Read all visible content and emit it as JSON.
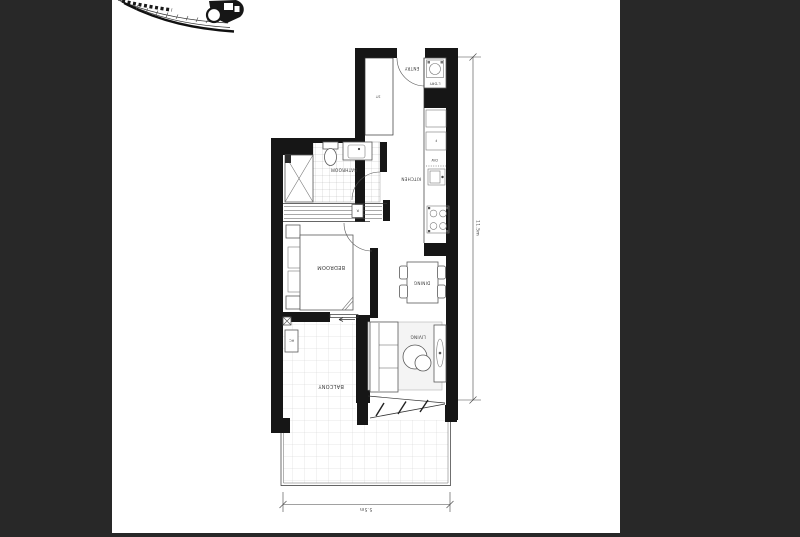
{
  "colors": {
    "canvas_bg": "#282828",
    "page_bg": "#ffffff",
    "wall": "#161616",
    "tile_line": "#cfcfcf"
  },
  "floorplan": {
    "labels": {
      "entry": "ENTRY",
      "laundry": "L'DRY",
      "storage": "ST",
      "fridge": "F",
      "dishwasher": "DW",
      "kitchen": "KITCHEN",
      "bathroom": "BATHROOM",
      "robe": "R",
      "bedroom": "BEDROOM",
      "dining": "DINING",
      "living": "LIVING",
      "ac": "AC",
      "balcony": "BALCONY"
    },
    "dimensions": {
      "vertical": "11.5m",
      "horizontal": "5.5m"
    }
  }
}
